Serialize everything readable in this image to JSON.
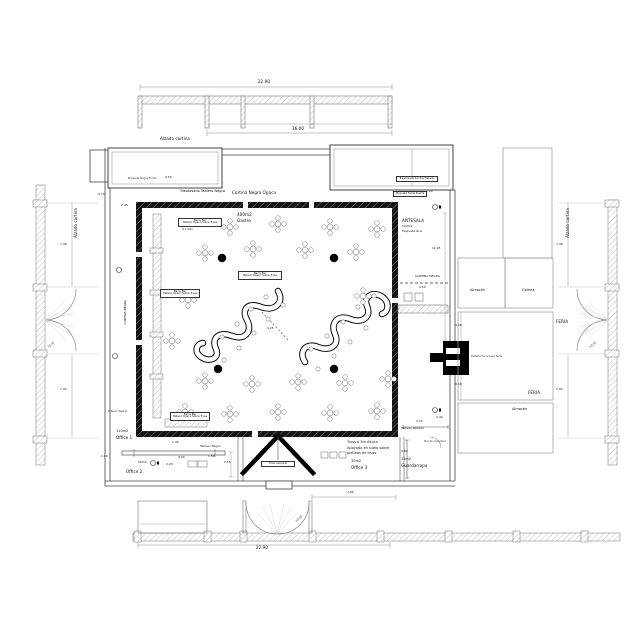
{
  "texts": {
    "dim_top": "22.90",
    "dim_16": "16.00",
    "alzado_cortina": "Alzado cortina",
    "dim_950": "9.50",
    "note_tl_room": "Moqueta Negra Fondo",
    "trasdosado_negro": "Trasdosado Tablero Negro",
    "cortina_negra_opaca": "Cortina Negra Opaca",
    "trasdosado_contra": "Trasdosado Contrachapado",
    "moqueta_puerta": "Moqueta Ferial Puerta",
    "dim_120": "1.20",
    "antesala": "ANTESALA",
    "antesala_area": "100m2",
    "antesala_floor": "Moqueta Gris",
    "dim_1125": "11.25",
    "cortina_negra": "CORTINA NEGRA",
    "dim_450": "4.50",
    "gate_note": "Plataforma acceso Feria",
    "dim_300": "3.00",
    "gastro_area": "400m2",
    "gastro": "Gastro",
    "bar_title": "Barra Bar",
    "bar_sub": "Tablero Opaco Sobre Truss",
    "bar_h": "H 1.00m",
    "dim_425": "4.25",
    "dim_370": "3.70",
    "dim_245": "2.45",
    "tablero_tapado": "Tablero Tapado",
    "office1_area": "110m2",
    "office1": "Office 1",
    "dim_140": "1.40",
    "tablero_negro": "Tablero Negro",
    "dim_100": "1.00",
    "dim_900": "9.00",
    "dim_150": "1.50",
    "office2_area": "50m2",
    "dim_220": "2.20",
    "office2": "Office 2",
    "dim_215": "2.15",
    "truss_note1": "Truss a 3m Altura",
    "truss_note2": "Apoyado en suelo sobre",
    "truss_note3": "pletinas de truss",
    "truss_box": "Truss apoyado",
    "office3_area": "30m2",
    "office3": "Office 3",
    "dim_470": "4.70",
    "tablero_pintado": "Tablero Pintado",
    "puerta": "Puerta corredera",
    "dim_380": "3.80",
    "guardarropa_area": "15m2",
    "guardarropa": "Guardarropa",
    "dim_240": "2.40",
    "almacen": "Almacén",
    "galeria": "Galería",
    "feria": "FERIA",
    "dim_730": "7.30",
    "h300": "h3.00",
    "dim_760": "7.60",
    "dim_bottom": "22.90"
  },
  "colors": {
    "wall": "#111111",
    "line": "#555555",
    "light_line": "#999999"
  },
  "symbols": {
    "tables": [
      [
        230,
        227
      ],
      [
        278,
        224
      ],
      [
        330,
        227
      ],
      [
        377,
        229
      ],
      [
        205,
        253
      ],
      [
        253,
        249
      ],
      [
        305,
        250
      ],
      [
        356,
        252
      ],
      [
        188,
        300
      ],
      [
        363,
        296
      ],
      [
        172,
        341
      ],
      [
        205,
        381
      ],
      [
        252,
        384
      ],
      [
        298,
        382
      ],
      [
        345,
        383
      ],
      [
        388,
        379
      ],
      [
        185,
        412
      ],
      [
        230,
        414
      ],
      [
        278,
        412
      ],
      [
        330,
        413
      ],
      [
        377,
        411
      ]
    ],
    "columns": [
      [
        222,
        258
      ],
      [
        334,
        258
      ],
      [
        218,
        369
      ],
      [
        334,
        369
      ]
    ],
    "stools": [
      [
        266,
        297
      ],
      [
        251,
        309
      ],
      [
        237,
        324
      ],
      [
        222,
        337
      ],
      [
        283,
        305
      ],
      [
        268,
        319
      ],
      [
        254,
        333
      ],
      [
        239,
        348
      ],
      [
        224,
        360
      ],
      [
        311,
        349
      ],
      [
        327,
        336
      ],
      [
        343,
        322
      ],
      [
        318,
        369
      ],
      [
        334,
        356
      ],
      [
        350,
        342
      ],
      [
        366,
        328
      ],
      [
        358,
        307
      ],
      [
        374,
        296
      ]
    ]
  }
}
